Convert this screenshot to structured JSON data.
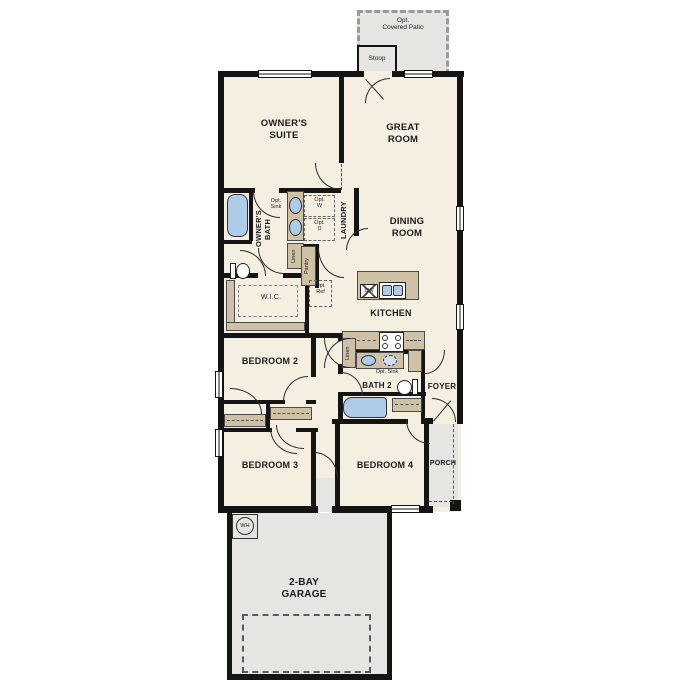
{
  "plan_title": "Single-story 4-bedroom floor plan with 2-bay garage",
  "colors": {
    "wall": "#141414",
    "floor": "#f5efe2",
    "concrete": "#e7e5e1",
    "cabinet": "#cfc1a5",
    "fixture_blue": "#aecbe8"
  },
  "rooms": {
    "covered_patio": "Opt.\nCovered Patio",
    "stoop": "Stoop",
    "owners_suite": "OWNER'S\nSUITE",
    "great_room": "GREAT\nROOM",
    "dining_room": "DINING\nROOM",
    "owners_bath": "OWNER'S\nBATH",
    "laundry": "LAUNDRY",
    "wic": "W.I.C.",
    "kitchen": "KITCHEN",
    "bath2": "BATH 2",
    "foyer": "FOYER",
    "bedroom2": "BEDROOM 2",
    "bedroom3": "BEDROOM 3",
    "bedroom4": "BEDROOM 4",
    "porch": "PORCH",
    "garage": "2-BAY\nGARAGE"
  },
  "features": {
    "opt_sink_owners": "Opt.\nSink",
    "opt_washer": "Opt.\nW",
    "opt_dryer": "Opt.\nD",
    "linen_owners": "Linen",
    "pantry": "Pantry",
    "opt_ref": "Opt.\nRef",
    "dishwasher": "DW",
    "linen_hall": "Linen",
    "opt_sink_bath2": "Opt. Sink",
    "water_heater": "WH"
  }
}
